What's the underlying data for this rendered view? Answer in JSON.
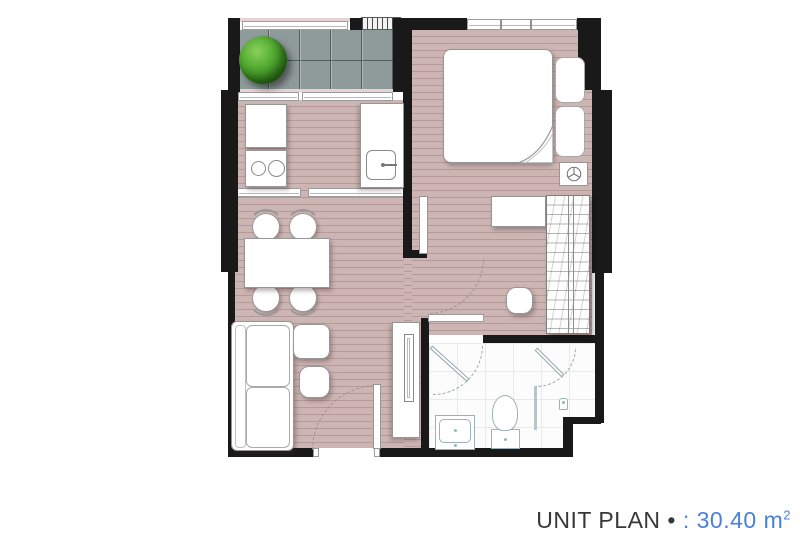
{
  "title": {
    "label": "UNIT PLAN",
    "bullet": "•",
    "colon": ":",
    "area_value": "30.40",
    "area_unit": "m",
    "area_superscript": "2",
    "full_text": "UNIT PLAN • : 30.40 m²"
  },
  "colors": {
    "accent_blue": "#4a80d9",
    "title_text": "#383838",
    "wall_black": "#191919",
    "wood_floor_mauve": "#c9b1af",
    "balcony_tile_gray": "#8f9a9b",
    "bathroom_floor_white": "#fcfcfc",
    "tree_green": "#3f9428"
  }
}
